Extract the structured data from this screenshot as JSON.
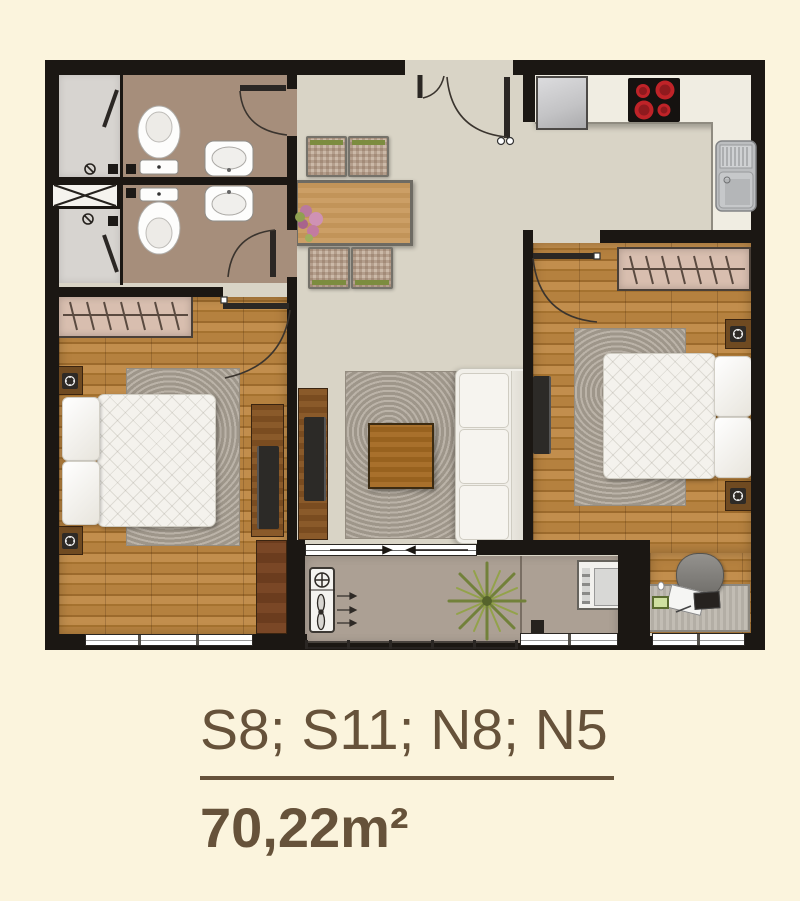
{
  "footer": {
    "unit_codes": "S8; S11; N8; N5",
    "area": "70,22m²"
  },
  "palette": {
    "background": "#FBF4DD",
    "wall": "#1B1713",
    "floor_hall": "#D9D4C6",
    "floor_wood": "#B5813F",
    "floor_bathroom": "#A68E7B",
    "floor_shower": "#D7D4D0",
    "floor_balcony": "#ACA094",
    "counter": "#F0EDE2",
    "cabinet_wood": "#7C4F22",
    "wardrobe": "#D8BEAF",
    "textile_white": "#F4F2ED",
    "rug_gray": "#B2ABA0",
    "sofa": "#F1EFE9",
    "burner_red": "#BF2328",
    "chair_green": "#7C8C3F",
    "plant_green": "#76863B",
    "text_brown": "#66523A"
  },
  "icons": [
    "toilet-icon",
    "washbasin-icon",
    "shower-door-icon",
    "shaft-cross-icon",
    "stove-burners-icon",
    "kitchen-sink-icon",
    "fridge-icon",
    "door-swing-icon",
    "entrance-double-door-icon",
    "sliding-door-arrows-icon",
    "bed-lamp-icon",
    "tv-icon",
    "plant-icon",
    "flower-vase-icon",
    "ac-unit-icon",
    "ventilation-fan-icon",
    "washing-machine-icon",
    "hanger-rail-icon",
    "balcony-railing-icon",
    "desk-laptop-icon"
  ]
}
